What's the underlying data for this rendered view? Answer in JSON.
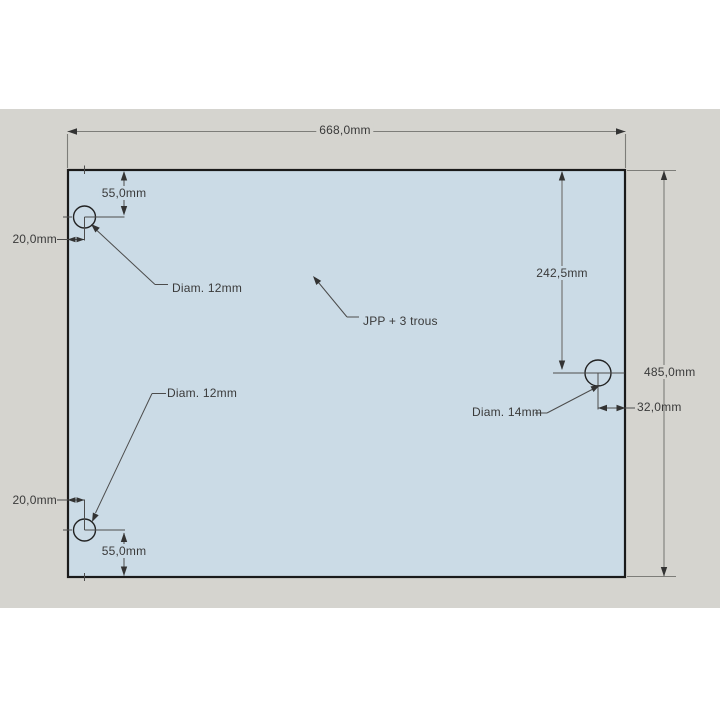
{
  "drawing": {
    "annotation": "JPP + 3 trous",
    "dims": {
      "width": "668,0mm",
      "height": "485,0mm",
      "right_hole_top_offset": "242,5mm",
      "right_hole_edge_offset": "32,0mm",
      "top_hole_top_offset": "55,0mm",
      "top_hole_left_offset": "20,0mm",
      "bottom_hole_bottom_offset": "55,0mm",
      "bottom_hole_left_offset": "20,0mm"
    },
    "holes": {
      "top_left_label": "Diam. 12mm",
      "bottom_left_label": "Diam. 12mm",
      "right_label": "Diam. 14mm"
    },
    "colors": {
      "background": "#d5d4cf",
      "plate_fill": "#cbdbe6",
      "plate_outline": "#1a1a1a",
      "dim_line": "#7d7d79",
      "detail_line": "#4c4c4c",
      "arrow": "#333333",
      "text": "#3a3a3a"
    }
  }
}
